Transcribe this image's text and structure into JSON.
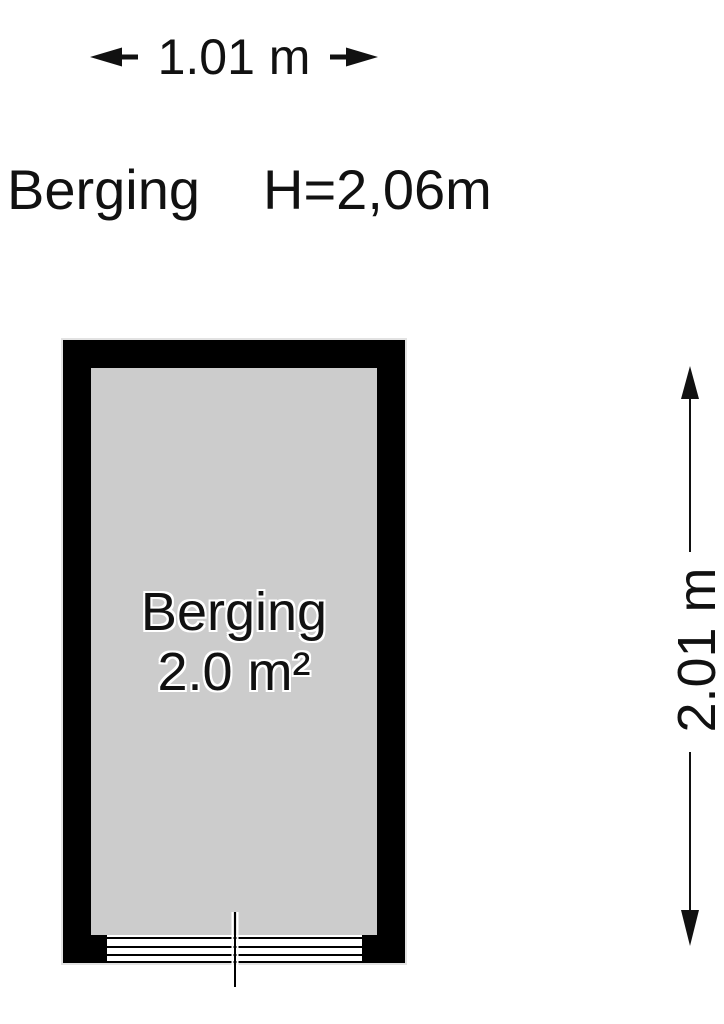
{
  "dimensions": {
    "width_label": "1.01 m",
    "height_label": "2.01 m"
  },
  "header": {
    "room_name": "Berging",
    "ceiling_height": "H=2,06m"
  },
  "room": {
    "name": "Berging",
    "area": "2.0 m²"
  },
  "colors": {
    "wall": "#000000",
    "floor": "#cccccc",
    "background": "#ffffff",
    "text": "#111111"
  }
}
